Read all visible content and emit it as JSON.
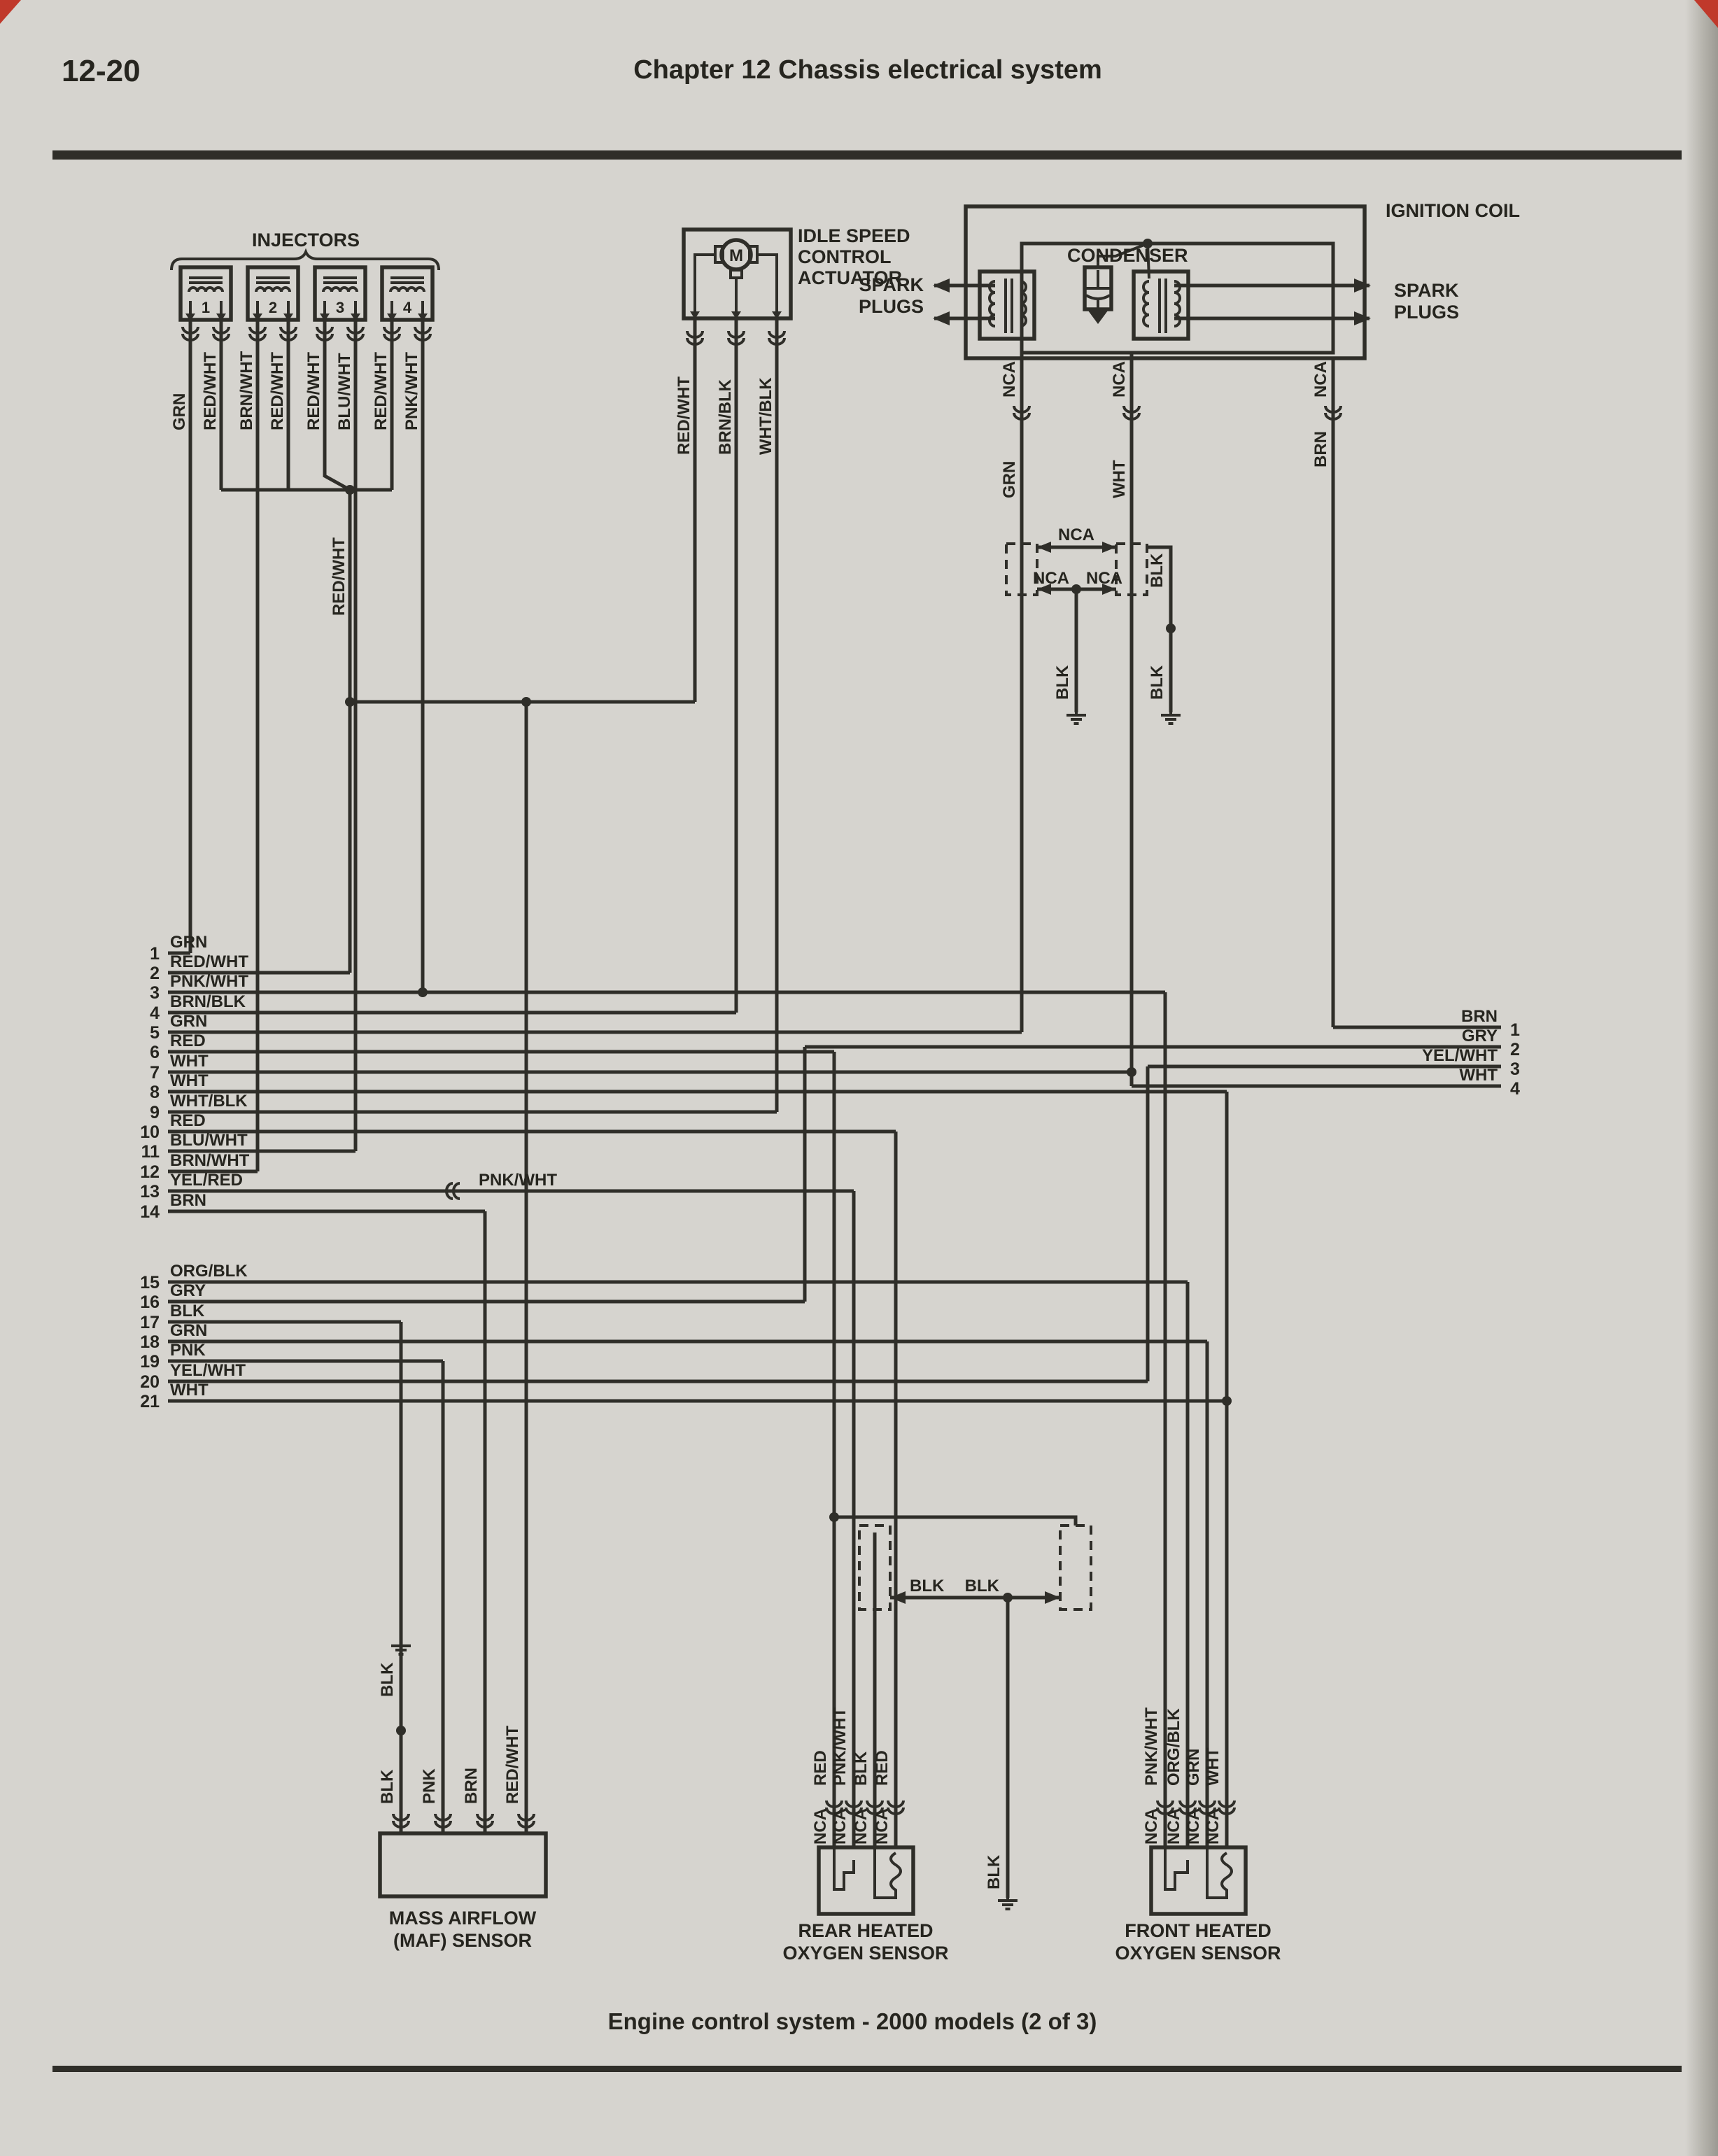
{
  "header": {
    "page_number": "12-20",
    "chapter_title": "Chapter 12  Chassis electrical system"
  },
  "footer": {
    "caption": "Engine control system - 2000 models (2 of 3)"
  },
  "colors": {
    "page_bg": "#d6d4cf",
    "ink": "#2f2e29",
    "corner_mark": "#c0392b"
  },
  "injectors": {
    "title": "INJECTORS",
    "units": [
      {
        "num": "1",
        "left": "GRN",
        "right": "RED/WHT"
      },
      {
        "num": "2",
        "left": "BRN/WHT",
        "right": "RED/WHT"
      },
      {
        "num": "3",
        "left": "RED/WHT",
        "right": "BLU/WHT"
      },
      {
        "num": "4",
        "left": "RED/WHT",
        "right": "PNK/WHT"
      }
    ],
    "bus_label": "RED/WHT"
  },
  "isc": {
    "title_lines": [
      "IDLE SPEED",
      "CONTROL",
      "ACTUATOR"
    ],
    "motor": "M",
    "wires": [
      "RED/WHT",
      "BRN/BLK",
      "WHT/BLK"
    ]
  },
  "coil": {
    "title": "IGNITION COIL",
    "condenser": "CONDENSER",
    "spark_left": [
      "SPARK",
      "PLUGS"
    ],
    "spark_right": [
      "SPARK",
      "PLUGS"
    ],
    "nca": "NCA",
    "wires": {
      "grn": "GRN",
      "wht": "WHT",
      "brn": "BRN"
    },
    "blk": "BLK"
  },
  "maf": {
    "title_lines": [
      "MASS AIRFLOW",
      "(MAF) SENSOR"
    ],
    "wires": [
      "BLK",
      "PNK",
      "BRN",
      "RED/WHT"
    ],
    "blk_upper": "BLK"
  },
  "rear_o2": {
    "title_lines": [
      "REAR HEATED",
      "OXYGEN SENSOR"
    ],
    "wires": [
      "RED",
      "PNK/WHT",
      "BLK",
      "RED"
    ],
    "nca": "NCA"
  },
  "front_o2": {
    "title_lines": [
      "FRONT HEATED",
      "OXYGEN SENSOR"
    ],
    "wires": [
      "PNK/WHT",
      "ORG/BLK",
      "GRN",
      "WHT"
    ],
    "nca": "NCA"
  },
  "ground_net": {
    "blk": "BLK"
  },
  "left_terminals": [
    {
      "n": "1",
      "label": "GRN"
    },
    {
      "n": "2",
      "label": "RED/WHT"
    },
    {
      "n": "3",
      "label": "PNK/WHT"
    },
    {
      "n": "4",
      "label": "BRN/BLK"
    },
    {
      "n": "5",
      "label": "GRN"
    },
    {
      "n": "6",
      "label": "RED"
    },
    {
      "n": "7",
      "label": "WHT"
    },
    {
      "n": "8",
      "label": "WHT"
    },
    {
      "n": "9",
      "label": "WHT/BLK"
    },
    {
      "n": "10",
      "label": "RED"
    },
    {
      "n": "11",
      "label": "BLU/WHT"
    },
    {
      "n": "12",
      "label": "BRN/WHT"
    },
    {
      "n": "13",
      "label": "YEL/RED"
    },
    {
      "n": "14",
      "label": "BRN"
    },
    {
      "n": "15",
      "label": "ORG/BLK"
    },
    {
      "n": "16",
      "label": "GRY"
    },
    {
      "n": "17",
      "label": "BLK"
    },
    {
      "n": "18",
      "label": "GRN"
    },
    {
      "n": "19",
      "label": "PNK"
    },
    {
      "n": "20",
      "label": "YEL/WHT"
    },
    {
      "n": "21",
      "label": "WHT"
    }
  ],
  "l13_right_label": "PNK/WHT",
  "right_terminals": [
    {
      "n": "1",
      "label": "BRN"
    },
    {
      "n": "2",
      "label": "GRY"
    },
    {
      "n": "3",
      "label": "YEL/WHT"
    },
    {
      "n": "4",
      "label": "WHT"
    }
  ]
}
